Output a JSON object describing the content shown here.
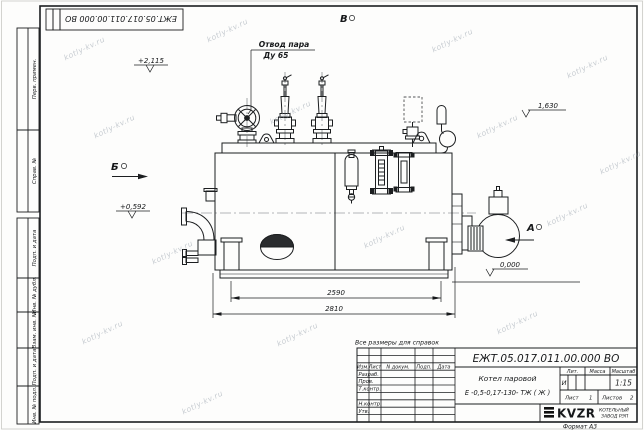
{
  "sheet": {
    "watermark": "kotly-kv.ru",
    "format_note": "Формат А3",
    "reference_note": "Все размеры для справок"
  },
  "margin": {
    "top_stamp_number": "ЕЖТ.05.017.011.00.000  ВО",
    "perv_primen": "Перв. примен.",
    "sprav_no": "Справ. №",
    "podp_i_data_upper": "Подп. и дата",
    "inv_no_dubl": "Инв. № дубл.",
    "vzam_inv_no": "Взам. инв. №",
    "podp_i_data_lower": "Подп. и дата",
    "inv_no_podl": "Инв. № подл."
  },
  "drawing": {
    "steam_outlet_line1": "Отвод пара",
    "steam_outlet_line2": "Ду 65",
    "view_top": "В",
    "view_left": "Б",
    "view_right": "А",
    "elev_top_left": "+2,115",
    "elev_right": "1,630",
    "elev_mid_left": "+0,592",
    "elev_zero": "0,000",
    "dim_inner": "2590",
    "dim_outer": "2810"
  },
  "title_block": {
    "doc_number": "ЕЖТ.05.017.011.00.000  ВО",
    "product_line1": "Котел паровой",
    "product_line2": "Е -0,5-0,17-130- ТЖ ( Ж )",
    "hdr_izm": "Изм.",
    "hdr_list": "Лист",
    "hdr_dokum": "N докум.",
    "hdr_podp": "Подп.",
    "hdr_data": "Дата",
    "row_razrab": "Разраб.",
    "row_prov": "Пров.",
    "row_tkontr": "Т.контр.",
    "row_nkontr": "Н.контр.",
    "row_utv": "Утв.",
    "hdr_lit": "Лит.",
    "hdr_mass": "Масса",
    "hdr_scale": "Масштаб",
    "lit_value": "И",
    "scale_value": "1:15",
    "sheet_word": "Лист",
    "sheet_num": "1",
    "sheets_word": "Листов",
    "sheets_num": "2",
    "logo_text": "KVZR",
    "company_line1": "КОТЕЛЬНЫЙ",
    "company_line2": "ЗАВОД РЭП"
  }
}
